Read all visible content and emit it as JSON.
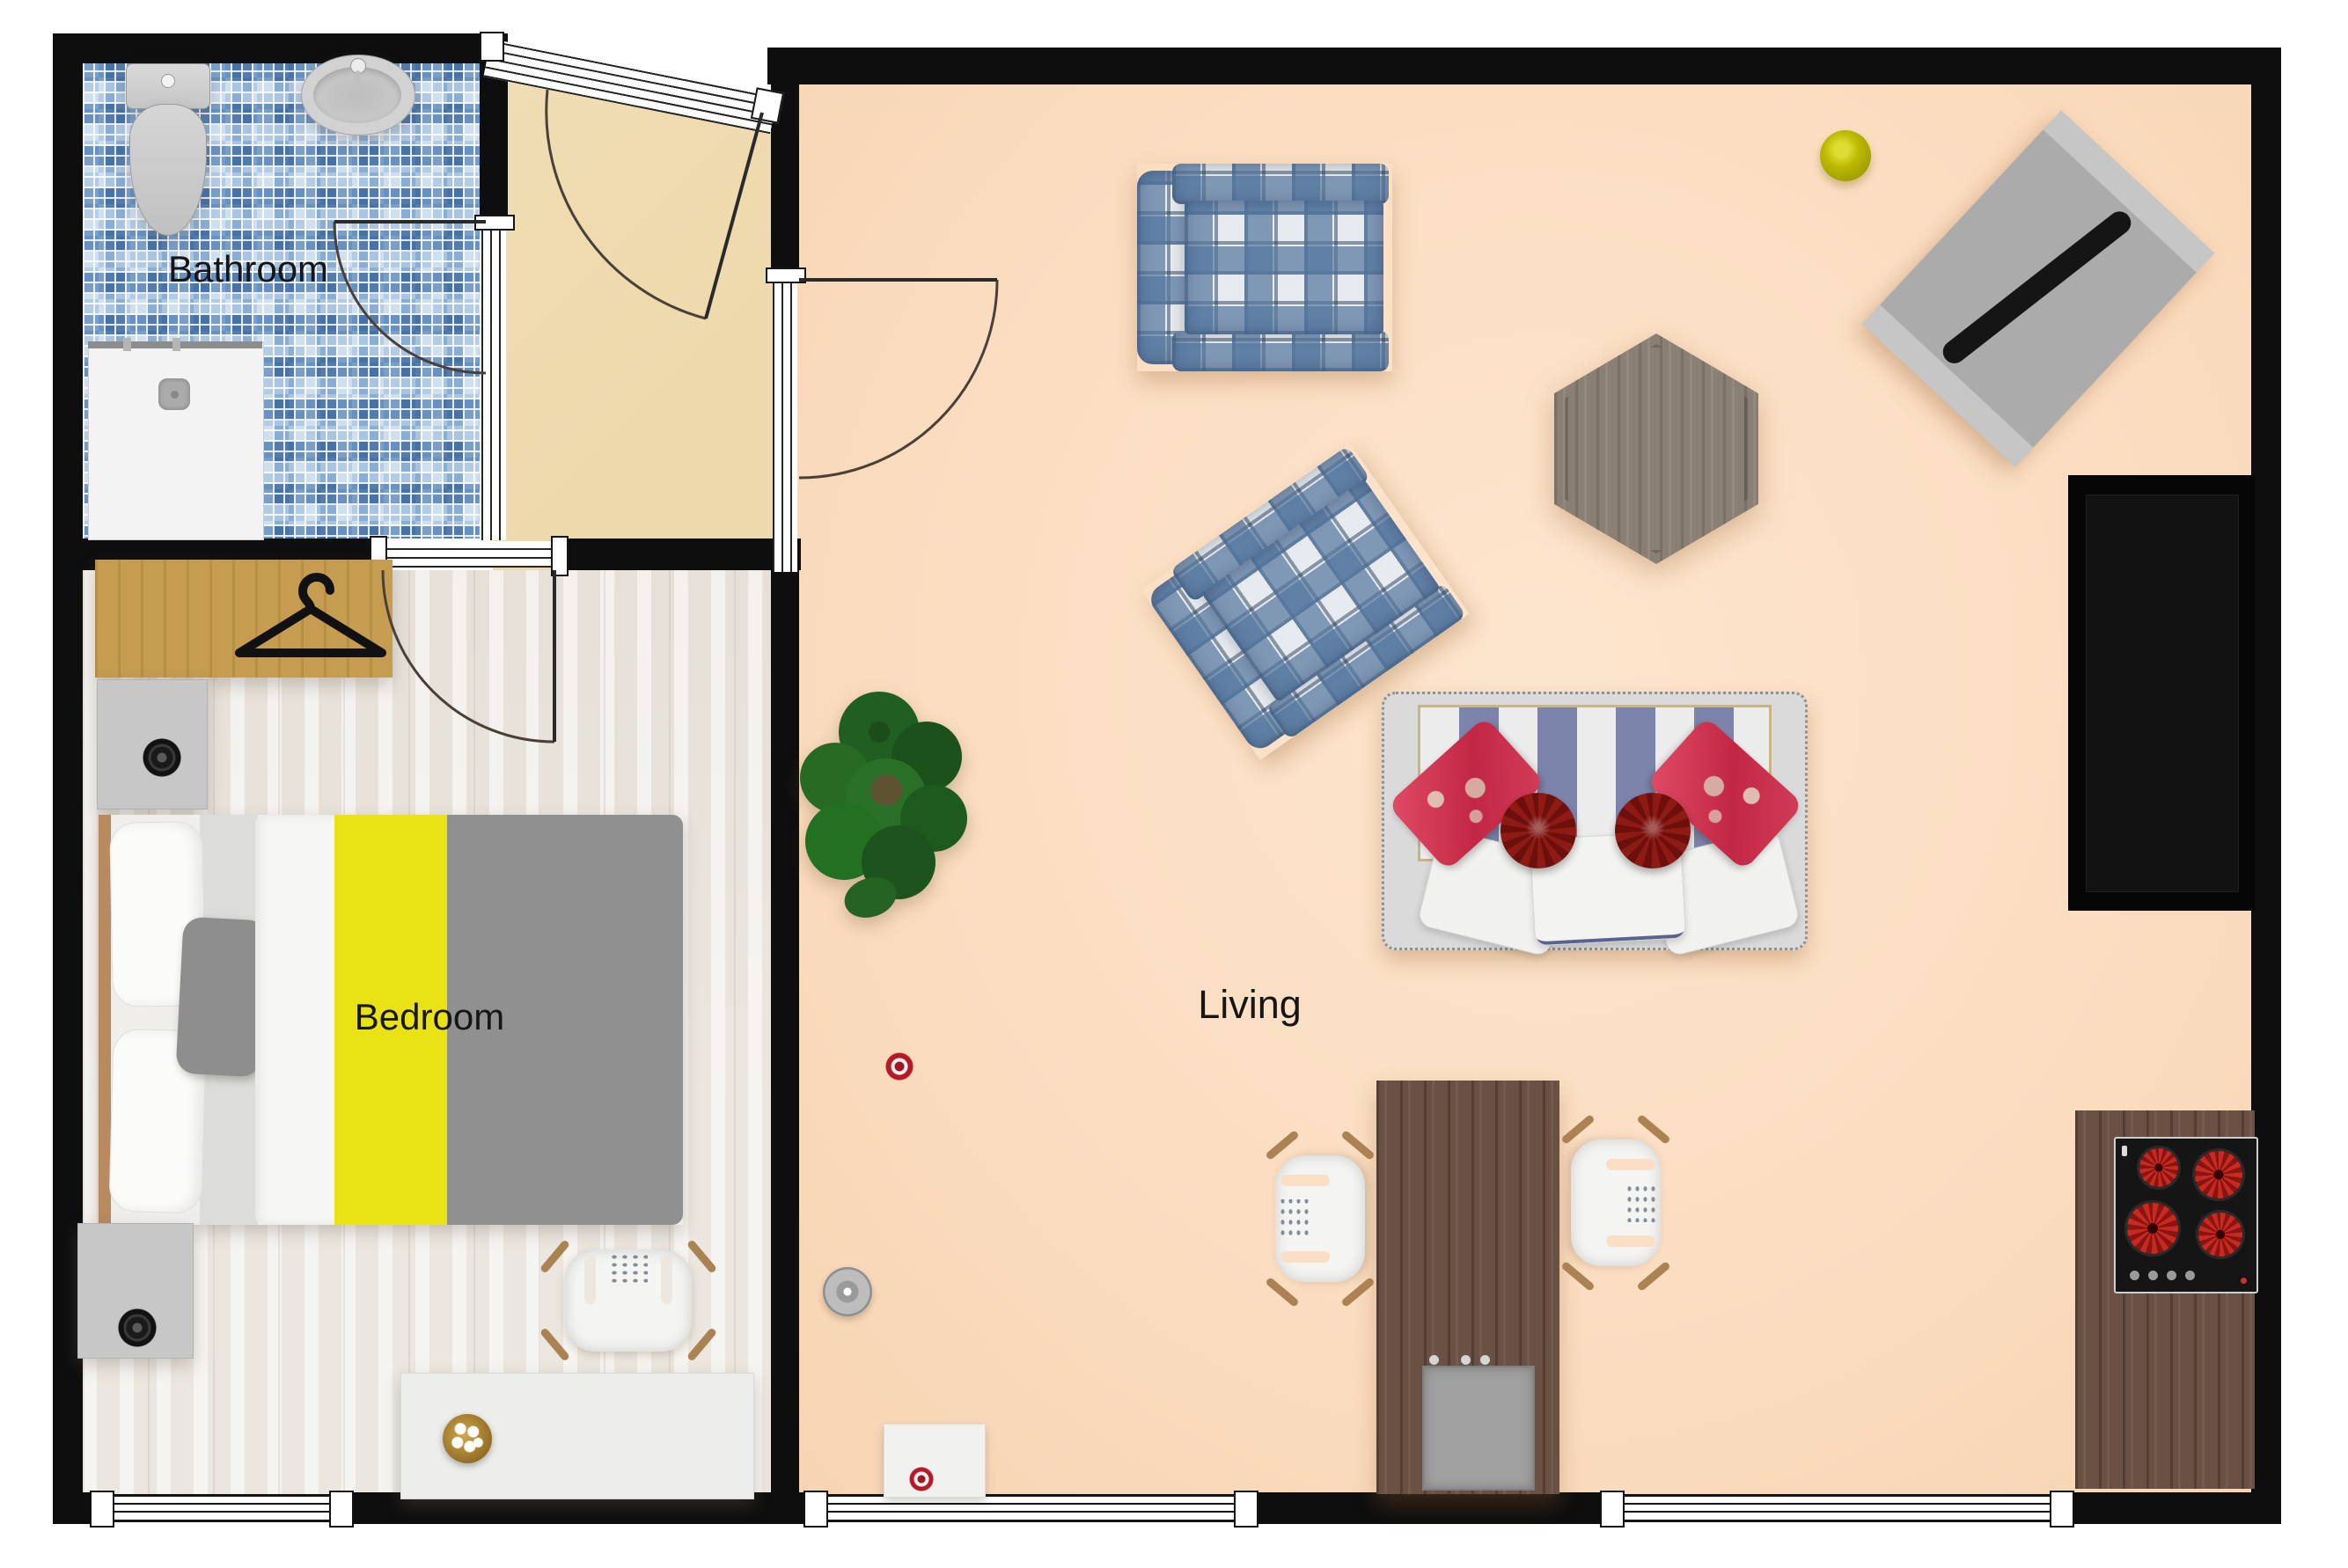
{
  "floor_plan": {
    "type": "apartment-floor-plan-top-view",
    "rooms": [
      {
        "id": "bathroom",
        "label": "Bathroom"
      },
      {
        "id": "bedroom",
        "label": "Bedroom"
      },
      {
        "id": "living",
        "label": "Living"
      }
    ],
    "furniture_inventory": {
      "bathroom": [
        "toilet",
        "sink",
        "shower"
      ],
      "hallway": [
        "entry-door",
        "bathroom-door",
        "living-door",
        "bedroom-door"
      ],
      "bedroom": [
        "wardrobe-with-hanger",
        "nightstand-top",
        "double-bed",
        "nightstand-bottom",
        "desk-chair",
        "desk",
        "gold-bowl",
        "window"
      ],
      "living": [
        "plaid-armchair-1",
        "plaid-armchair-2",
        "hexagon-coffee-table",
        "striped-sofa-with-pillows",
        "potted-plant",
        "dining-table-with-sink",
        "dining-chair-left",
        "dining-chair-right",
        "yellow-ball",
        "rotated-bench-with-board",
        "black-counter-niche",
        "kitchen-counter",
        "cooktop-4-burners",
        "red-ring-decor",
        "gray-disc-decor",
        "white-floor-box",
        "windows"
      ]
    }
  },
  "theme": {
    "wall": "#0e0e0e",
    "living_floor": "#fbddc1",
    "hallway_floor": "#eed9ac",
    "bedroom_floor": "#ebe6df",
    "tile_blue": "#6f9bc8",
    "wardrobe": "#c59c50",
    "bed_yellow": "#e9e316",
    "duvet_gray": "#909090",
    "headboard": "#b9895f",
    "sofa_frame": "#dadada",
    "sofa_blue": "#7d84ab",
    "sofa_trim": "#c9b483",
    "pillow_red": "#c22744",
    "pillow_round": "#8e1a16",
    "plaid_blue": "#53759e",
    "plaid_navy": "#23415f",
    "dark_wood": "#6a5144",
    "hex_table": "#8a7f74",
    "chair_wood": "#ab8352",
    "cooktop_red": "#c62a22",
    "ball_yellow": "#bcba00",
    "door_line": "#4a4038"
  }
}
